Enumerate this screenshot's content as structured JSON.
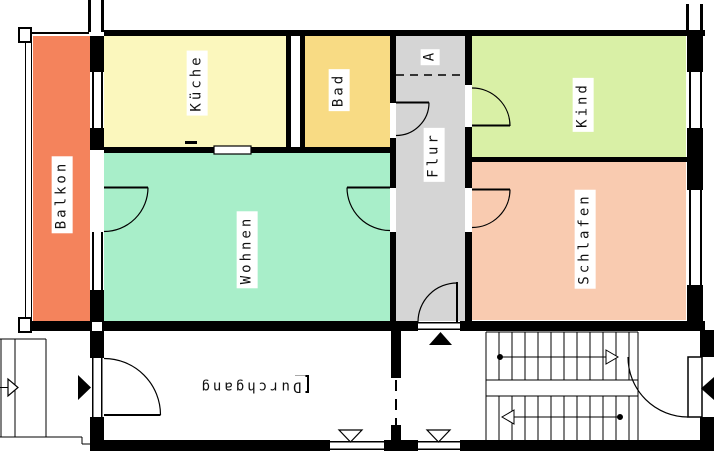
{
  "plan": {
    "type": "floorplan",
    "language": "de"
  },
  "rooms": {
    "balkon": {
      "label": "Balkon",
      "color": "#f4835c"
    },
    "kueche": {
      "label": "Küche",
      "color": "#fbf7bd"
    },
    "bad": {
      "label": "Bad",
      "color": "#f8db84"
    },
    "flur": {
      "label": "Flur",
      "color": "#d5d5d5"
    },
    "kind": {
      "label": "Kind",
      "color": "#d9f0a6"
    },
    "schlafen": {
      "label": "Schlafen",
      "color": "#f9cbb0"
    },
    "wohnen": {
      "label": "Wohnen",
      "color": "#a8eec9"
    },
    "durchgang": {
      "label": "Durchgang",
      "color": "#ffffff"
    }
  },
  "markers": {
    "section_a": "A"
  },
  "colors": {
    "wall": "#000000",
    "background": "#ffffff"
  }
}
